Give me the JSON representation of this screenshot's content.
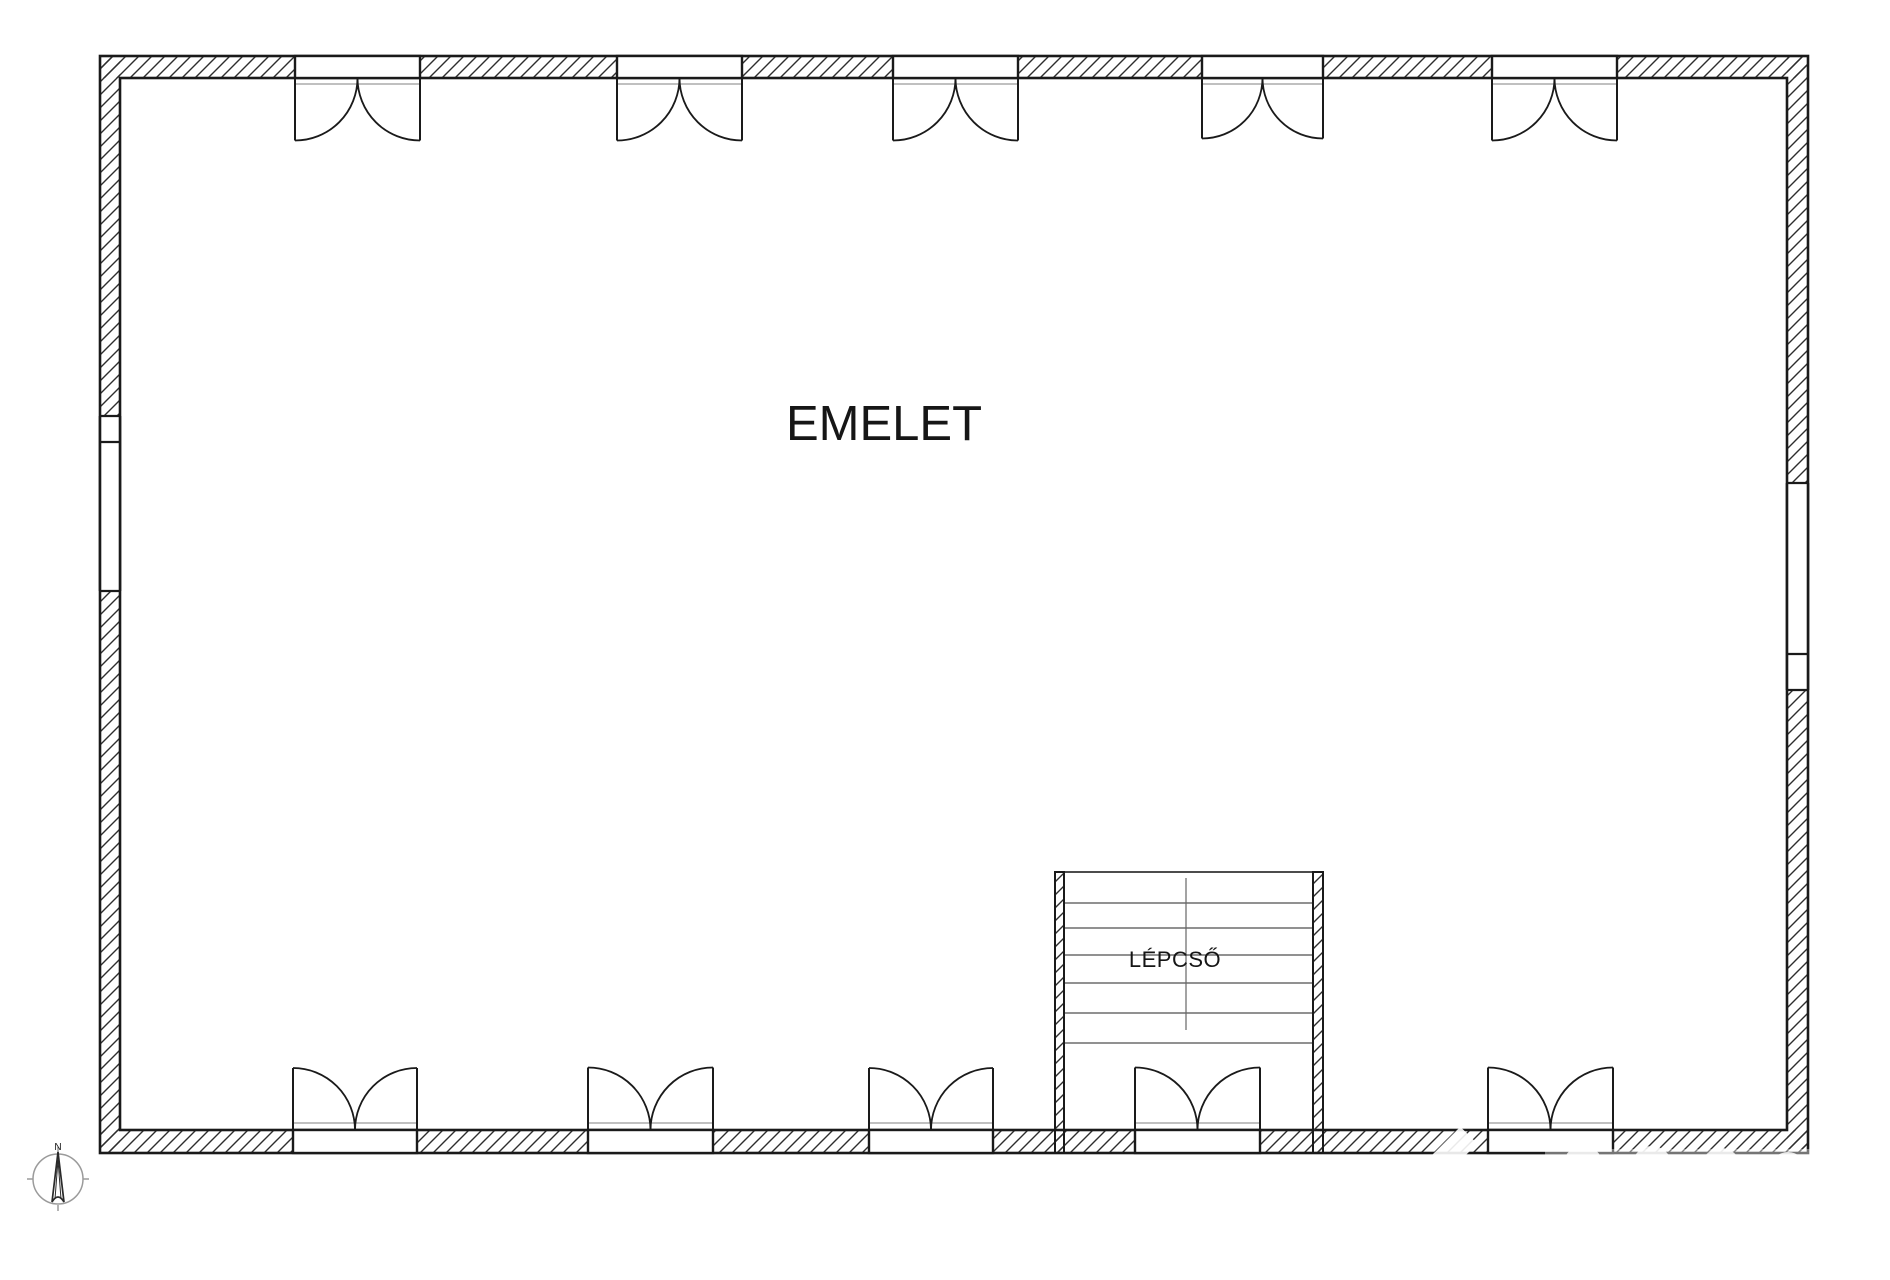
{
  "labels": {
    "floor": "EMELET",
    "staircase": "LÉPCSŐ"
  },
  "compass": {
    "north": "N"
  },
  "colors": {
    "background": "#ffffff",
    "wall_outline": "#1a1a1a",
    "hatch_line": "#2e2e2e",
    "stair_tread": "#4f4f4f",
    "threshold": "#9a9a9a",
    "compass_ring": "#9b9b9b",
    "needle": "#2a2a2a"
  }
}
